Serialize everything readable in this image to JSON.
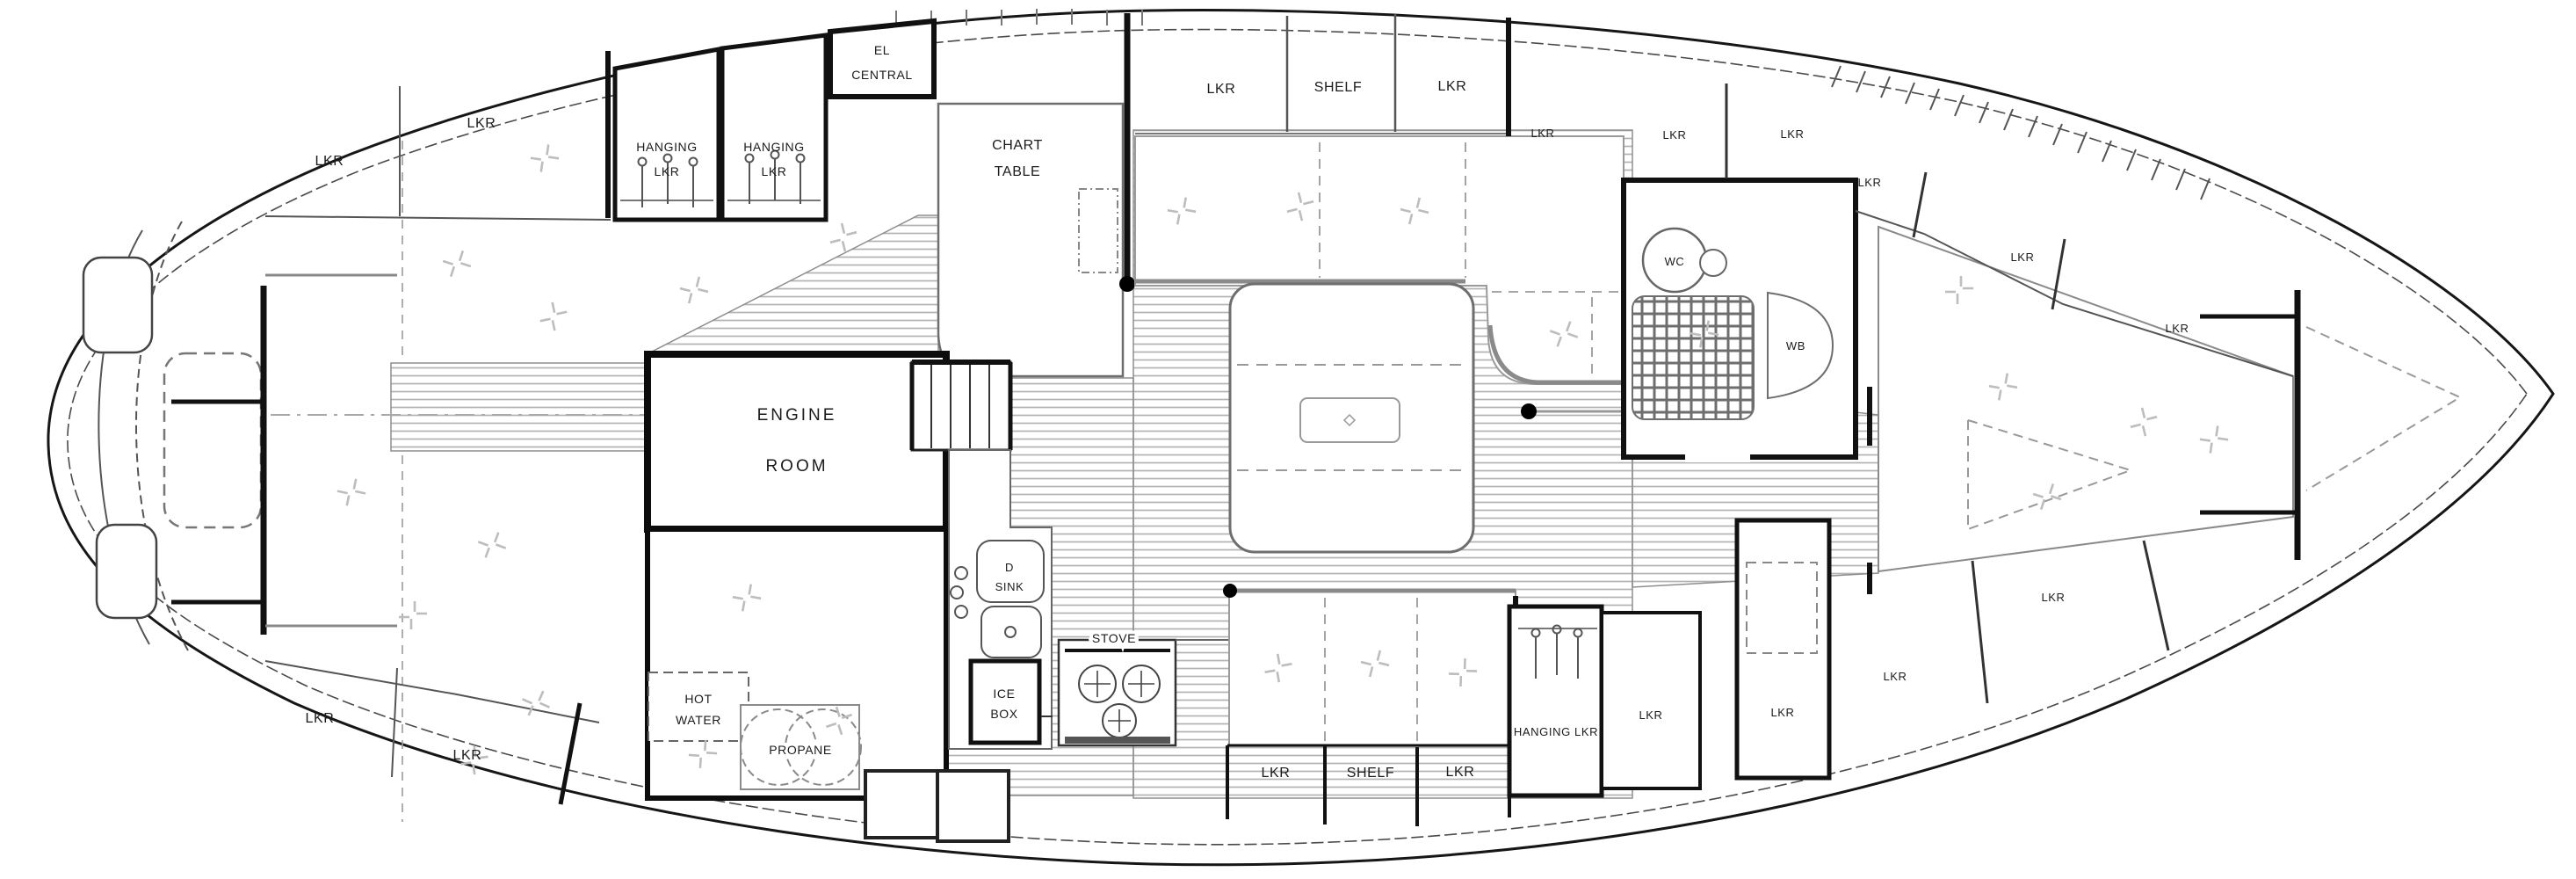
{
  "plan": {
    "labels": {
      "aft_hull_top_lkr_1": "LKR",
      "aft_hull_top_lkr_2": "LKR",
      "hanging_locker_1_line1": "HANGING",
      "hanging_locker_1_line2": "LKR",
      "hanging_locker_2_line1": "HANGING",
      "hanging_locker_2_line2": "LKR",
      "el_central_line1": "EL",
      "el_central_line2": "CENTRAL",
      "chart_table_line1": "CHART",
      "chart_table_line2": "TABLE",
      "salon_top_lkr_1": "LKR",
      "salon_top_shelf": "SHELF",
      "salon_top_lkr_2": "LKR",
      "hull_top_lkr": "LKR",
      "head_lkr_1": "LKR",
      "head_lkr_2": "LKR",
      "wc": "WC",
      "wb": "WB",
      "vberth_top_lkr_1": "LKR",
      "vberth_top_lkr_2": "LKR",
      "vberth_top_lkr_3": "LKR",
      "engine_room_line1": "ENGINE",
      "engine_room_line2": "ROOM",
      "sink_line1": "D",
      "sink_line2": "SINK",
      "ice_box_line1": "ICE",
      "ice_box_line2": "BOX",
      "stove": "STOVE",
      "hot_water_line1": "HOT",
      "hot_water_line2": "WATER",
      "propane": "PROPANE",
      "aft_hull_bottom_lkr_1": "LKR",
      "aft_hull_bottom_lkr_2": "LKR",
      "stbd_lkr_1": "LKR",
      "stbd_shelf": "SHELF",
      "stbd_lkr_2": "LKR",
      "fwd_hanging_lkr": "HANGING LKR",
      "fwd_lkr_1": "LKR",
      "fwd_lkr_2": "LKR",
      "vberth_bottom_lkr_1": "LKR",
      "vberth_bottom_lkr_2": "LKR"
    }
  }
}
